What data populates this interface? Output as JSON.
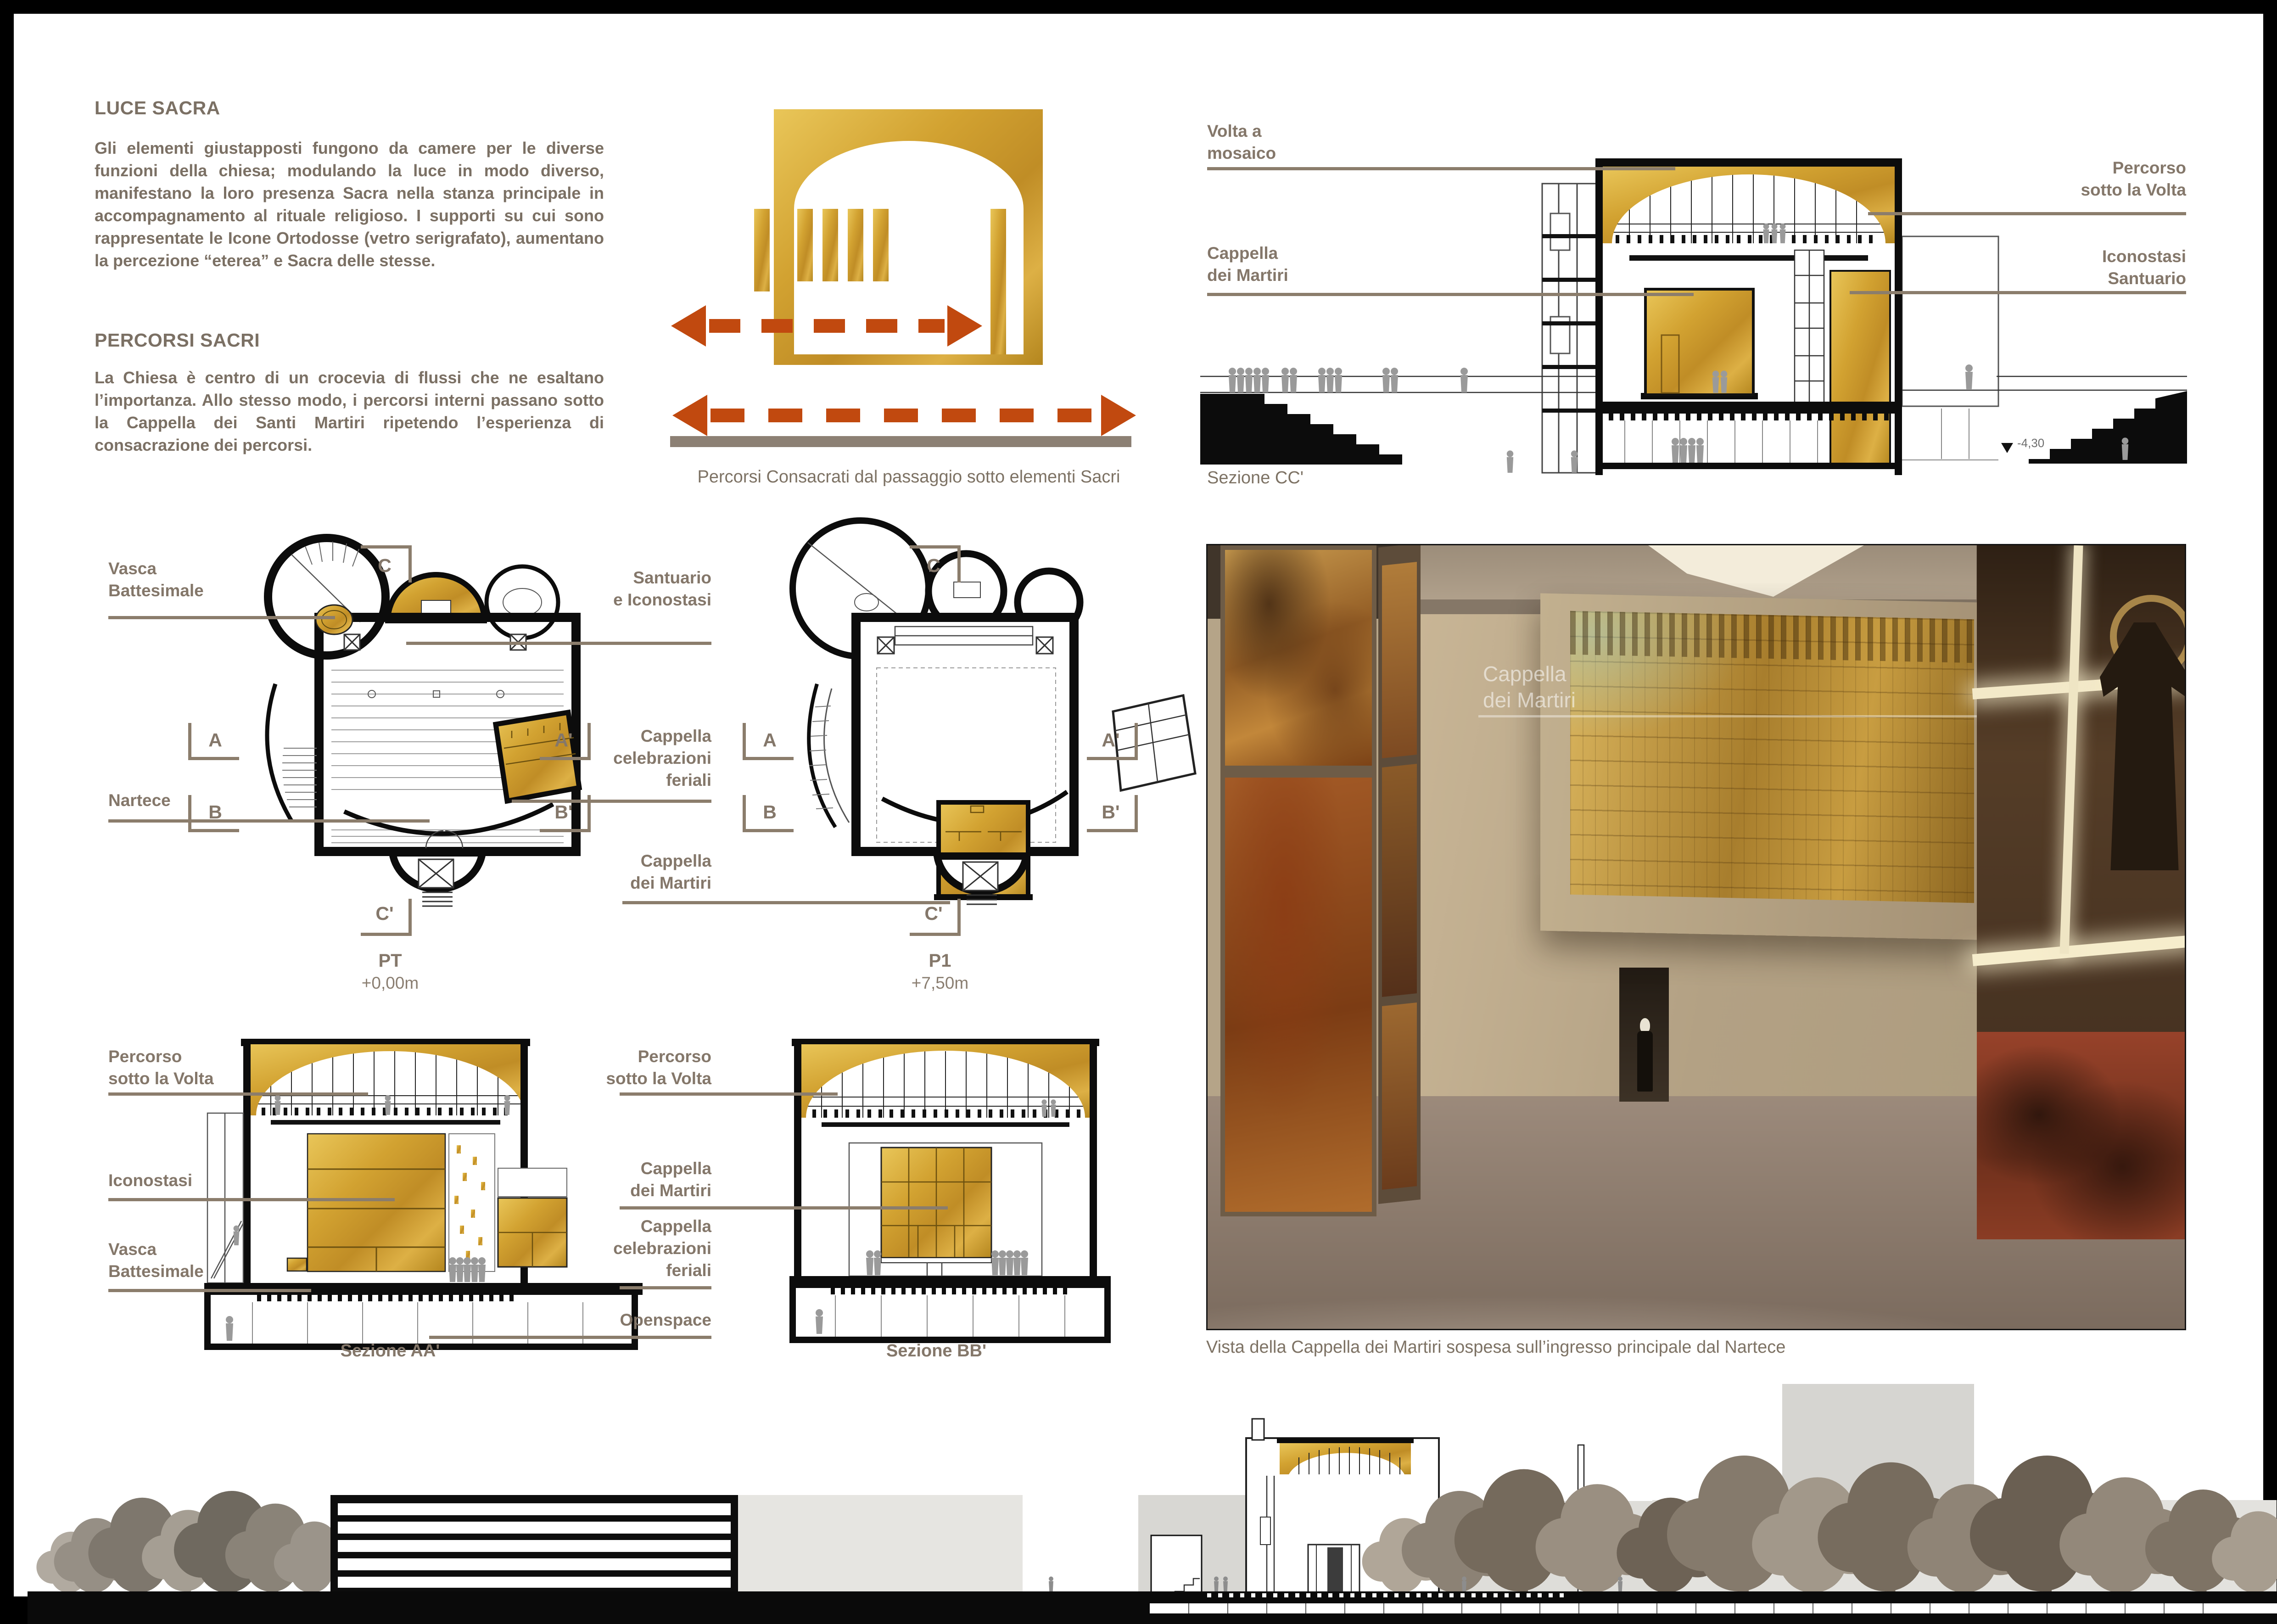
{
  "colors": {
    "gold": "#D6A52F",
    "rust": "#C1490F",
    "taupe_line": "#8B7D6C",
    "label_text": "#84776A",
    "body_text": "#7B7064",
    "grey_bar": "#8C8074"
  },
  "intro": {
    "title1": "LUCE SACRA",
    "body1": "Gli elementi giustapposti fungono da camere per le diverse funzioni della chiesa; modulando la luce in modo diverso, manifestano la loro presenza Sacra nella stanza principale in accompagnamento al rituale religioso. I supporti su cui sono rappresentate le Icone Ortodosse (vetro serigrafato), aumentano la percezione “eterea” e Sacra delle stesse.",
    "title2": "PERCORSI SACRI",
    "body2": "La Chiesa è centro di un crocevia di flussi che ne esaltano l’importanza. Allo stesso modo, i percorsi interni passano sotto la Cappella dei Santi Martiri ripetendo l’esperienza di consacrazione dei percorsi."
  },
  "diagram": {
    "caption": "Percorsi Consacrati dal passaggio sotto elementi Sacri"
  },
  "sezione_cc": {
    "label_volta": "Volta a\nmosaico",
    "label_cappella": "Cappella\ndei Martiri",
    "label_percorso": "Percorso\nsotto la Volta",
    "label_iconostasi": "Iconostasi\nSantuario",
    "caption": "Sezione CC'",
    "level": "-4,30"
  },
  "plans": {
    "label_vasca": "Vasca\nBattesimale",
    "label_nartece": "Nartece",
    "label_santuario": "Santuario\ne Iconostasi",
    "label_feriali": "Cappella\ncelebrazioni\nferiali",
    "label_martiri": "Cappella\ndei Martiri",
    "pt_name": "PT",
    "pt_level": "+0,00m",
    "p1_name": "P1",
    "p1_level": "+7,50m",
    "markers": {
      "a": "A",
      "a1": "A'",
      "b": "B",
      "b1": "B'",
      "c": "C",
      "c1": "C'"
    }
  },
  "sections": {
    "label_percorso": "Percorso\nsotto la Volta",
    "label_iconostasi": "Iconostasi",
    "label_vasca": "Vasca\nBattesimale",
    "label_martiri": "Cappella\ndei Martiri",
    "label_feriali": "Cappella\ncelebrazioni\nferiali",
    "label_openspace": "Openspace",
    "aa_caption": "Sezione AA'",
    "bb_caption": "Sezione BB'"
  },
  "render": {
    "watermark": "Cappella\ndei Martiri",
    "caption": "Vista della Cappella dei Martiri sospesa sull’ingresso principale dal Nartece"
  }
}
